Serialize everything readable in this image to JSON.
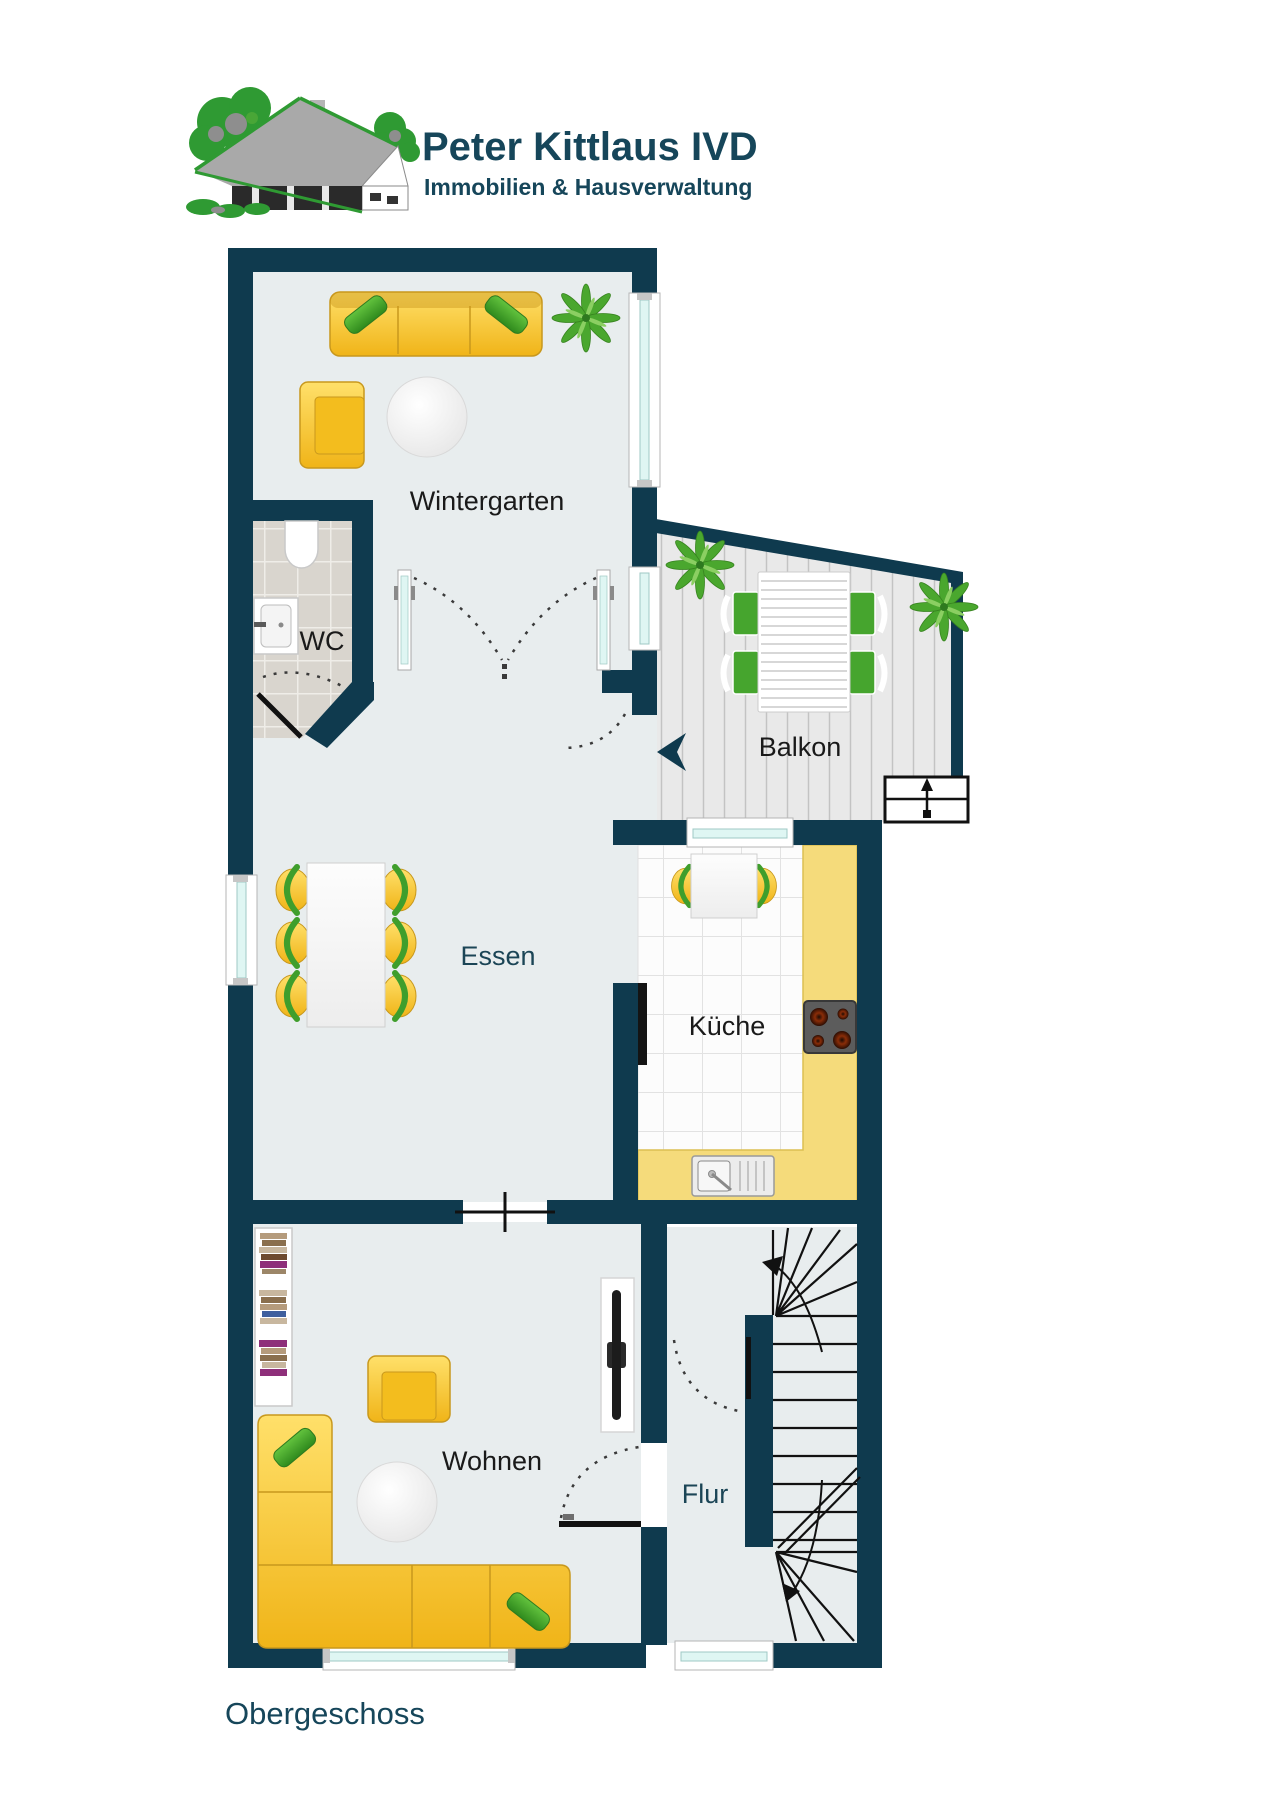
{
  "logo": {
    "company": "Peter Kittlaus IVD",
    "tagline": "Immobilien & Hausverwaltung",
    "icon": "house-logo-icon"
  },
  "plan": {
    "floor_label": "Obergeschoss",
    "rooms": [
      {
        "id": "wintergarten",
        "label": "Wintergarten",
        "label_color": "#1a1a1a"
      },
      {
        "id": "wc",
        "label": "WC",
        "label_color": "#1a1a1a"
      },
      {
        "id": "balkon",
        "label": "Balkon",
        "label_color": "#1a1a1a"
      },
      {
        "id": "essen",
        "label": "Essen",
        "label_color": "#1b4556"
      },
      {
        "id": "kueche",
        "label": "Küche",
        "label_color": "#1a1a1a"
      },
      {
        "id": "wohnen",
        "label": "Wohnen",
        "label_color": "#1a1a1a"
      },
      {
        "id": "flur",
        "label": "Flur",
        "label_color": "#1b4556"
      }
    ],
    "icons": [
      "sofa-icon",
      "armchair-icon",
      "round-table-icon",
      "plant-icon",
      "toilet-icon",
      "sink-icon",
      "dining-table-icon",
      "chair-icon",
      "balcony-table-icon",
      "stairs-icon",
      "stove-icon",
      "kitchen-sink-icon",
      "bookshelf-icon",
      "tv-icon",
      "corner-sofa-icon",
      "door-swing-icon",
      "entry-arrow-icon",
      "exterior-steps-icon"
    ],
    "colors": {
      "wall": "#0f3a4e",
      "floor": "#e8edee",
      "wc_tile": "#d9d5ce",
      "kitchen_tile": "#fcfcfc",
      "counter_yellow": "#f5db7b",
      "furniture_yellow": "#f7c92a",
      "accent_green": "#3f9e2c",
      "window_glass": "#dff6f3",
      "brand_text": "#16465a",
      "logo_green": "#2f9a33"
    }
  }
}
